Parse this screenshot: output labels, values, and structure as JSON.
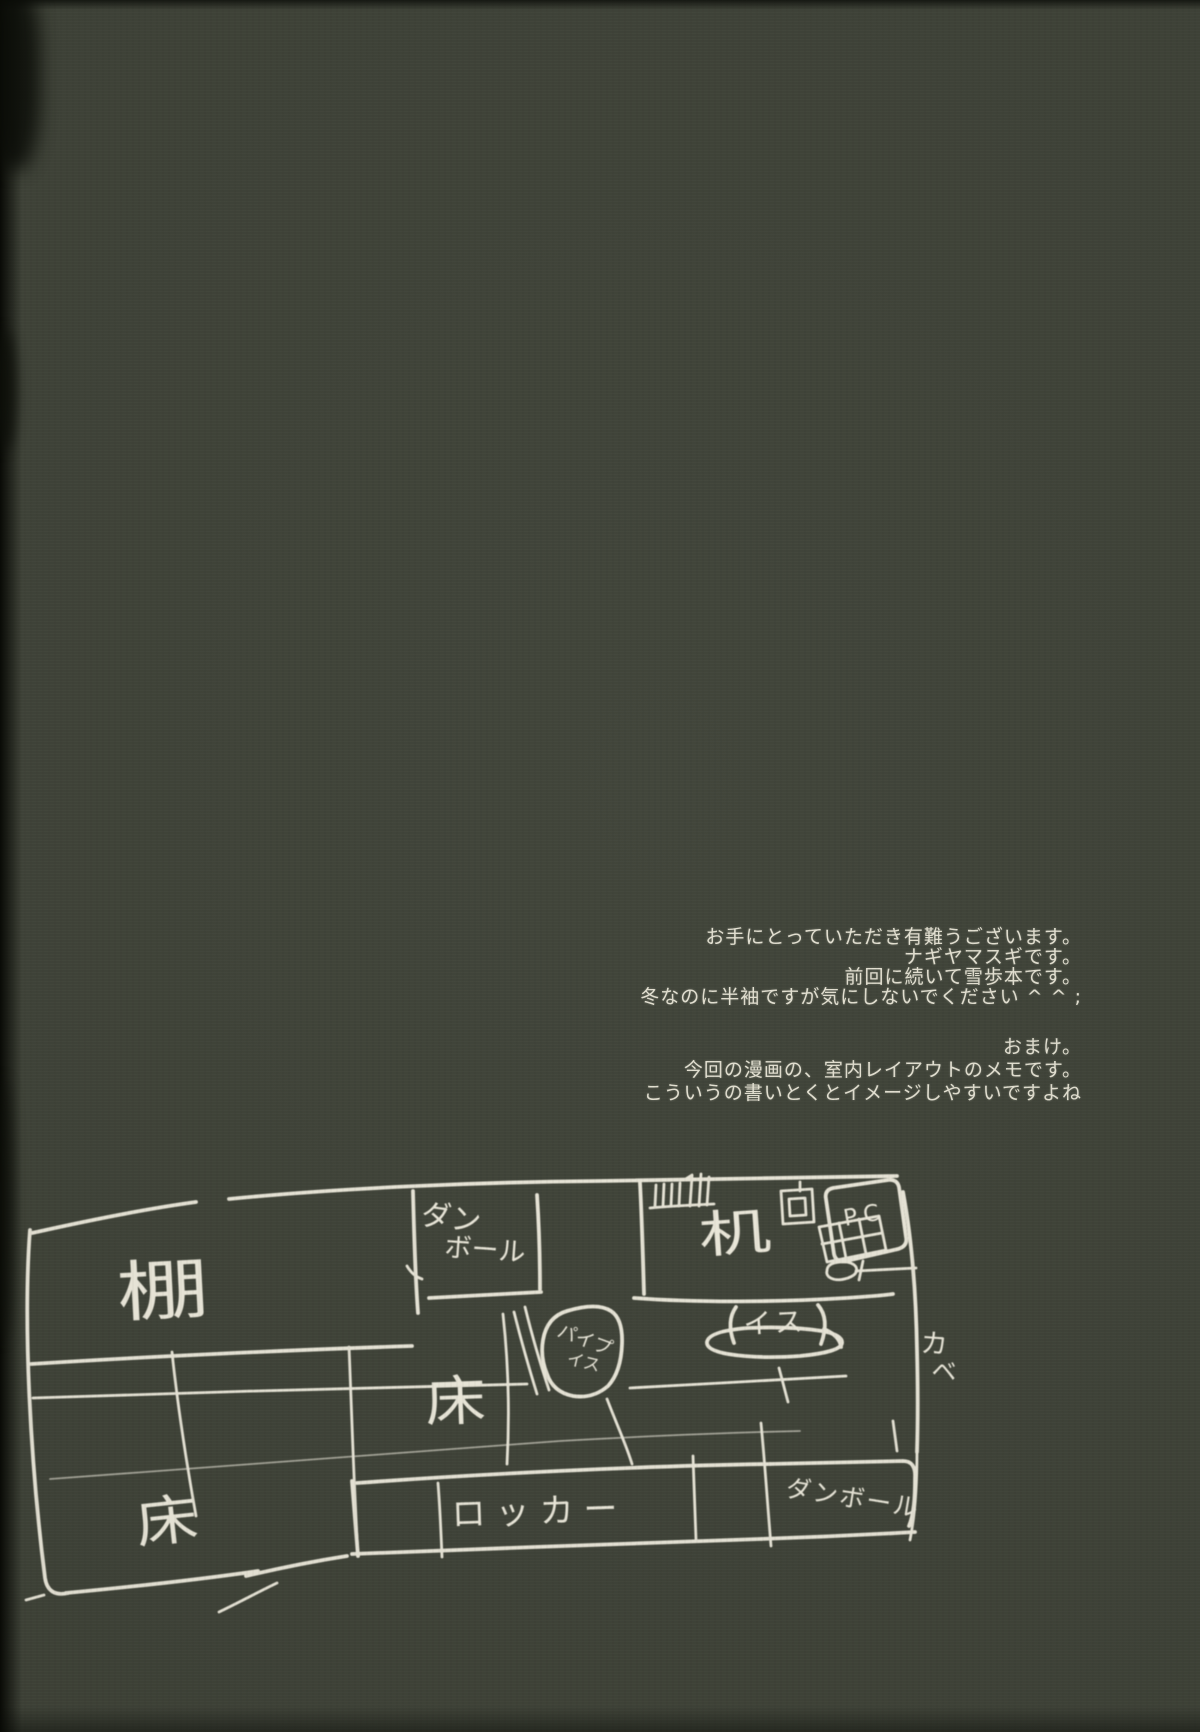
{
  "colors": {
    "paper": "#3e4237",
    "ink": "#e9e6d8"
  },
  "afterword": {
    "greeting_lines": [
      "お手にとっていただき有難うございます。",
      "ナギヤマスギです。",
      "前回に続いて雪歩本です。",
      "冬なのに半袖ですが気にしないでください ^ ^ ;"
    ],
    "omake_lines": [
      "おまけ。",
      "今回の漫画の、室内レイアウトのメモです。",
      "こういうの書いとくとイメージしやすいですよね"
    ]
  },
  "sketch": {
    "labels": {
      "shelf": "棚",
      "cardboard_top_line1": "ダン",
      "cardboard_top_line2": "ボール",
      "desk": "机",
      "pc": "PC",
      "chair": "イス",
      "pipe_chair_line1": "パイプ",
      "pipe_chair_line2": "イス",
      "floor_center": "床",
      "floor_bottom_left": "床",
      "locker": "ロッカー",
      "cardboard_bottom": "ダンボール",
      "wall_line1": "カ",
      "wall_line2": "ベ"
    }
  }
}
